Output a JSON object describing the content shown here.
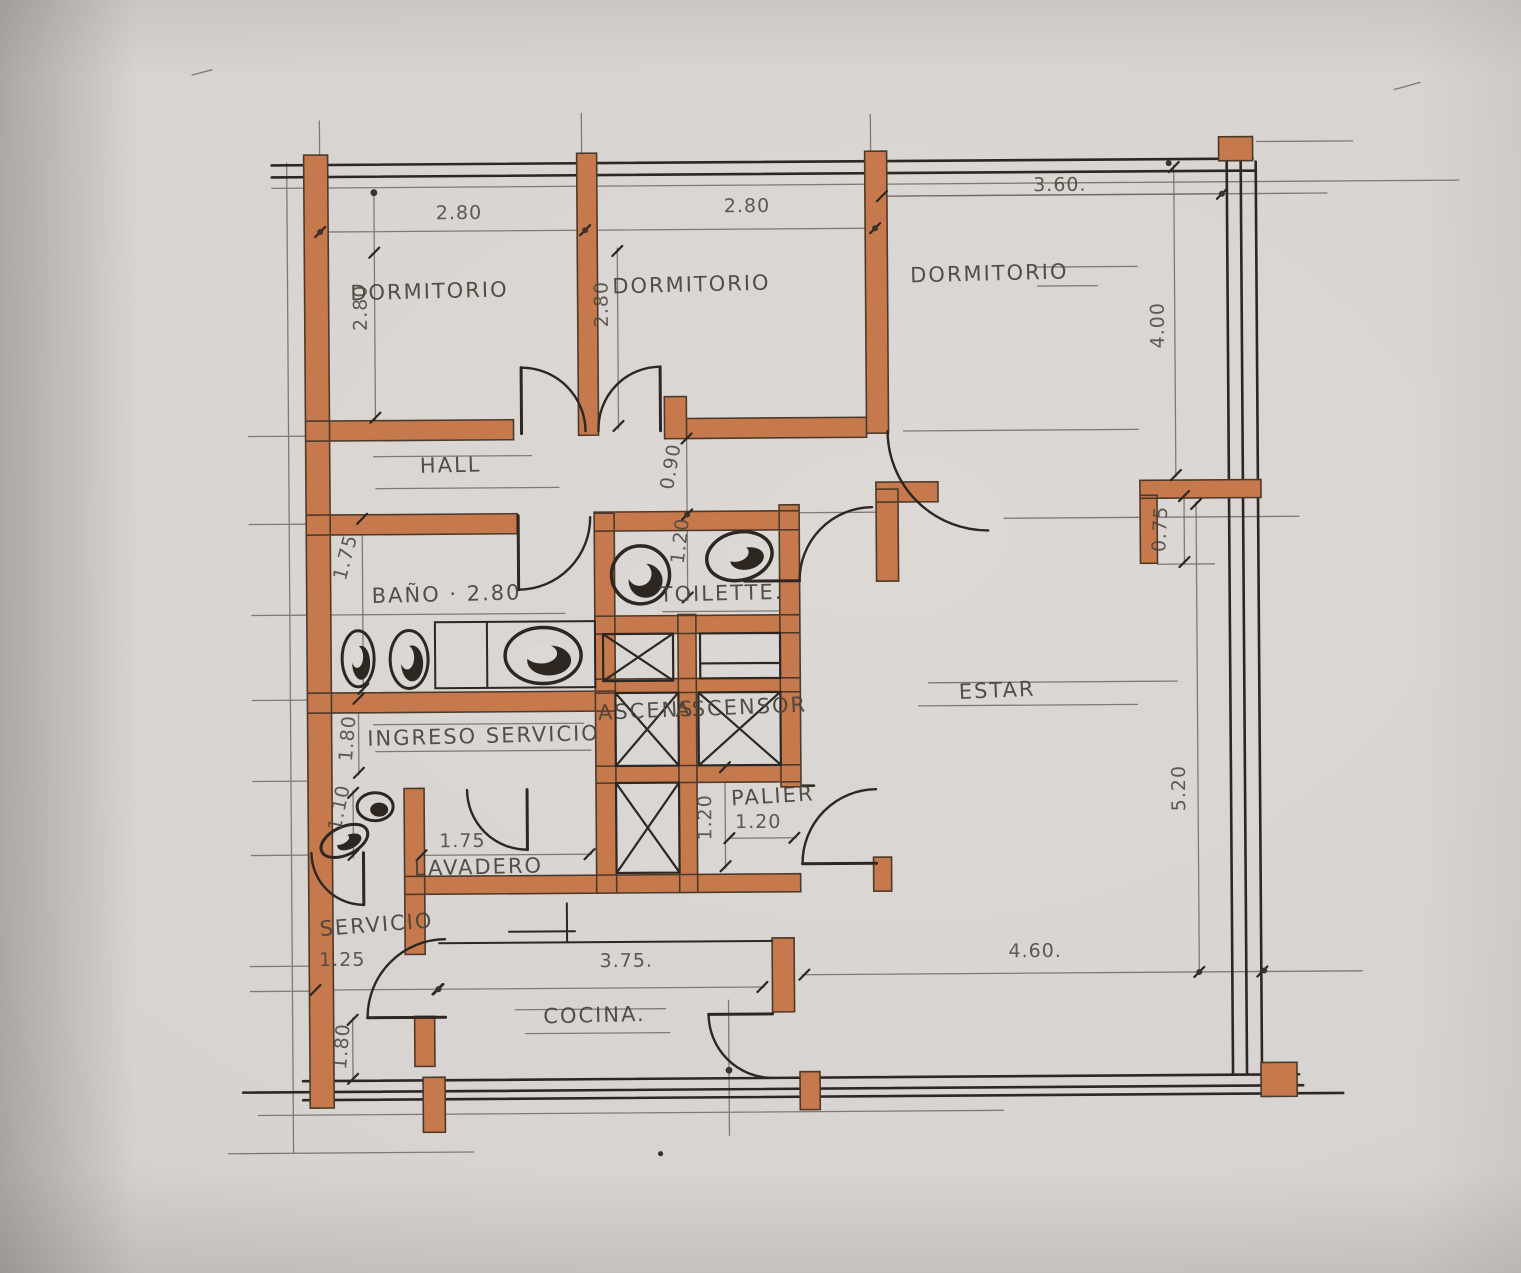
{
  "rooms": {
    "dormitorio1": "DORMITORIO",
    "dormitorio2": "DORMITORIO",
    "dormitorio3": "DORMITORIO",
    "hall": "HALL",
    "bano": "BAÑO · 2.80",
    "toilette": "TOILETTE.",
    "estar": "ESTAR",
    "ingreso_servicio": "INGRESO SERVICIO",
    "ascensor_izq": "ASCENS",
    "ascensor_der": "ASCENSOR",
    "palier": "PALIER",
    "lavadero": "LAVADERO",
    "servicio": "SERVICIO",
    "cocina": "COCINA."
  },
  "dimensions": {
    "top_dorm1": "2.80",
    "top_dorm2": "2.80",
    "top_dorm3": "3.60.",
    "dorm1_fondo": "2.80",
    "dorm2_fondo": "2.80",
    "dorm3_fondo": "4.00",
    "pasillo": "0.90",
    "toilette_fondo": "1.20",
    "bano_fondo": "1.75",
    "ingreso_fondo": "1.80",
    "servicio_bano": "1.10",
    "lavadero_ancho": "1.75",
    "palier_fondo": "1.20",
    "palier_ancho": "1.20",
    "servicio_ancho": "1.25",
    "cocina_alto": "1.80",
    "cocina_ancho": "3.75.",
    "estar_ancho": "4.60.",
    "estar_fondo": "5.20",
    "retiro": "0.75"
  },
  "colors": {
    "wall": "#c6794c",
    "wall_edge": "#4d3a2a",
    "ink": "#2e2721",
    "pencil": "#73695f",
    "label": "#4a423a",
    "paper": "#d9d5d2"
  }
}
